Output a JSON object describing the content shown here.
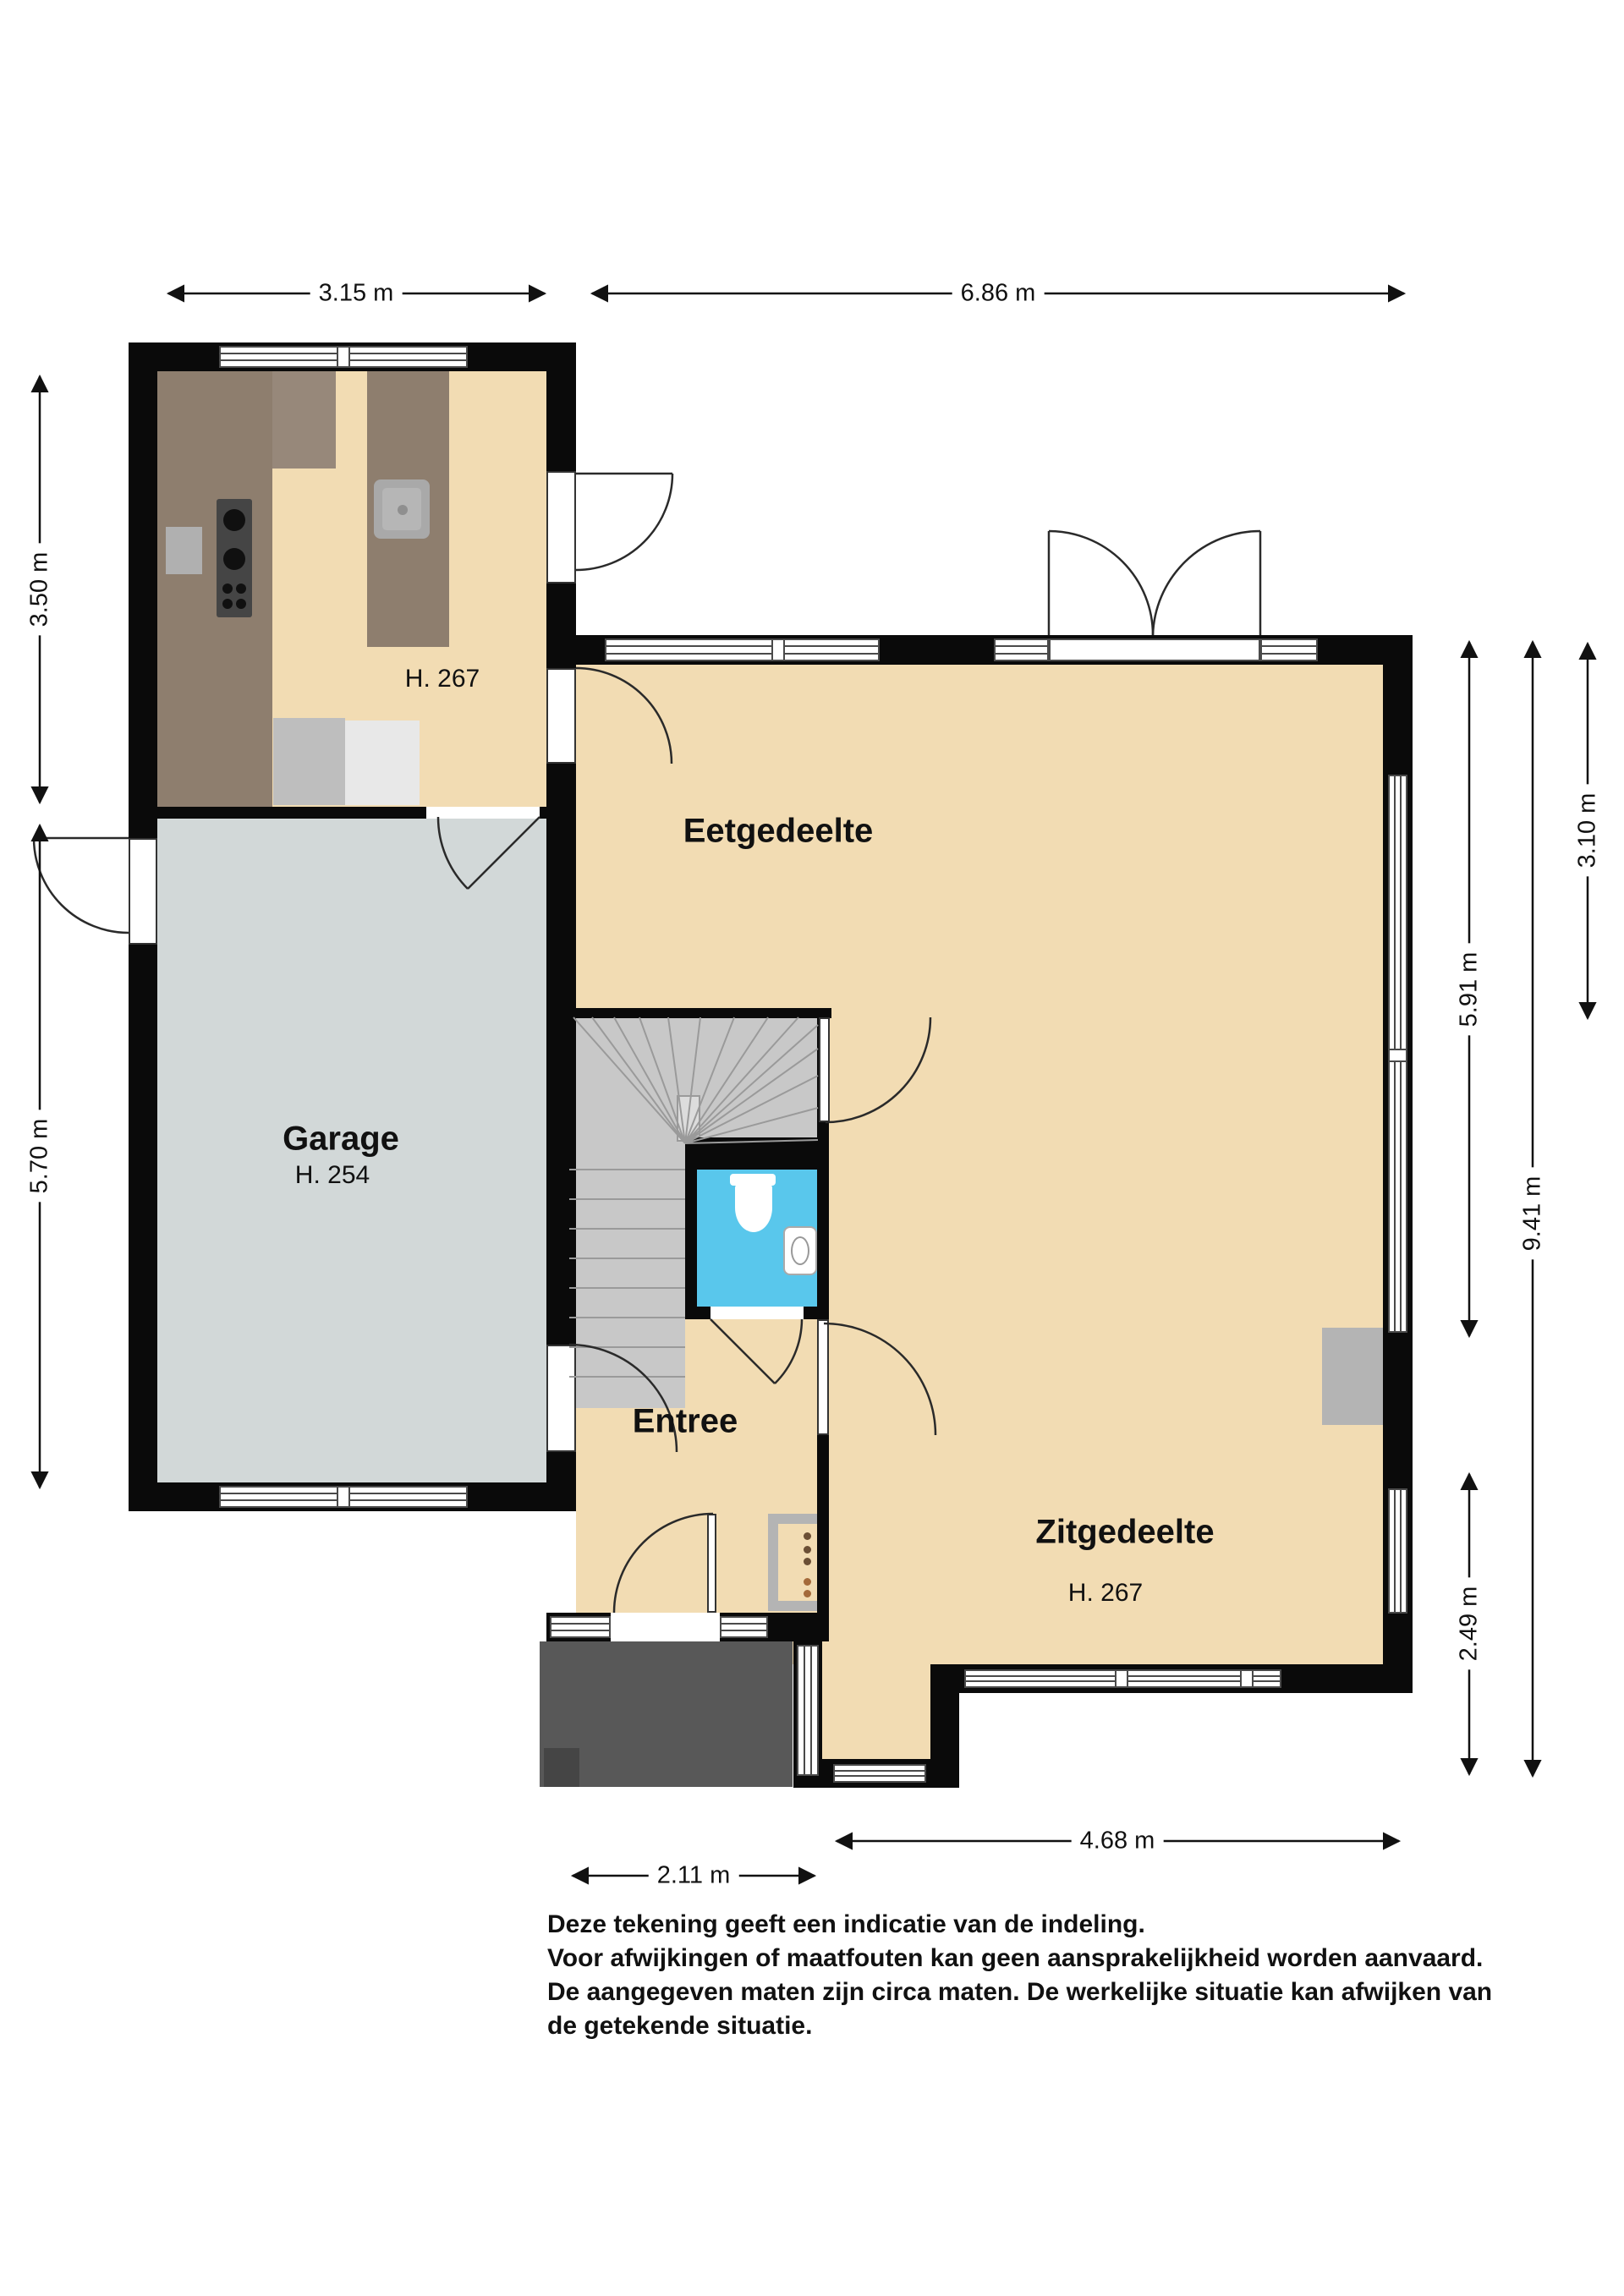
{
  "plan_title": "Begane grond plattegrond",
  "rooms": {
    "kitchen_height": "H. 267",
    "eetgedeelte": "Eetgedeelte",
    "garage": "Garage",
    "garage_height": "H. 254",
    "entree": "Entree",
    "zitgedeelte": "Zitgedeelte",
    "zitgedeelte_height": "H. 267"
  },
  "dims": {
    "d1": "3.15 m",
    "d2": "6.86 m",
    "d3": "3.50 m",
    "d4": "5.70 m",
    "d5": "5.91 m",
    "d6": "9.41 m",
    "d7": "3.10 m",
    "d8": "2.49 m",
    "d9": "4.68 m",
    "d10": "2.11 m"
  },
  "disclaimer": {
    "line1": "Deze tekening geeft een indicatie van de indeling.",
    "line2": "Voor  afwijkingen of maatfouten kan geen aansprakelijkheid worden aanvaard.",
    "line3": "De aangegeven maten zijn circa maten. De werkelijke situatie kan afwijken van",
    "line4": "de getekende situatie."
  },
  "colors": {
    "wall": "#0a0a0a",
    "beige": "#F2DCB3",
    "garage": "#D2D8D8",
    "stairs": "#C8C8C8",
    "toilet": "#59C7EC",
    "porch": "#585858",
    "counter": "#8E7E6E"
  }
}
